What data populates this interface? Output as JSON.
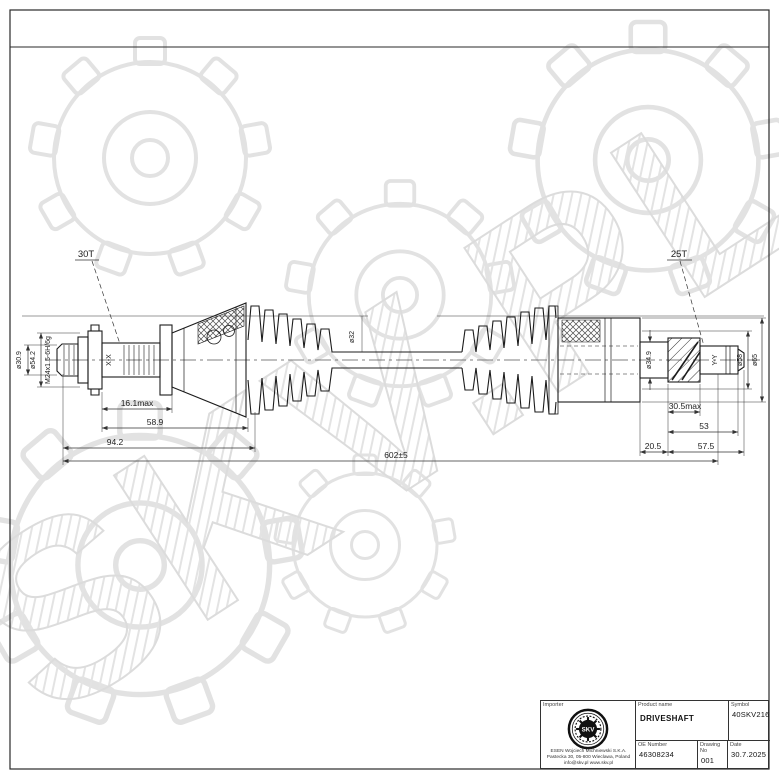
{
  "watermark": {
    "text": "SKV.PL"
  },
  "drawing": {
    "callouts": {
      "left_spline": "30T",
      "right_spline": "25T",
      "left_section": "X-X",
      "right_section": "Y-Y"
    },
    "dimensions": {
      "dia_stub": "ø30.9",
      "dia_flange": "ø54.2",
      "thread": "M24x1.5-6H/6g",
      "dia_shaft": "ø32",
      "dia_stub_right": "ø34.9",
      "dia_58": "ø58",
      "dia_65": "ø65",
      "len_16_1": "16.1max",
      "len_58_9": "58.9",
      "len_94_2": "94.2",
      "len_overall": "602±5",
      "len_20_5": "20.5",
      "len_30_5": "30.5max",
      "len_53": "53",
      "len_57_5": "57.5"
    }
  },
  "title_block": {
    "importer_label": "Importer",
    "product_name_label": "Product name",
    "product_name": "DRIVESHAFT",
    "symbol_label": "Symbol",
    "symbol": "40SKV216",
    "oe_number_label": "OE Number",
    "oe_number": "46308234",
    "drawing_no_label": "Drawing No",
    "drawing_no": "001",
    "date_label": "Date",
    "date": "30.7.2025",
    "logo_text": "SKV",
    "company": {
      "line1": "ESEN Wojciech Michniewski S.K.A.",
      "line2": "Pastecka 30, 05-800 Wieclawa, Poland",
      "line3": "info@skv.pl  www.skv.pl"
    }
  }
}
